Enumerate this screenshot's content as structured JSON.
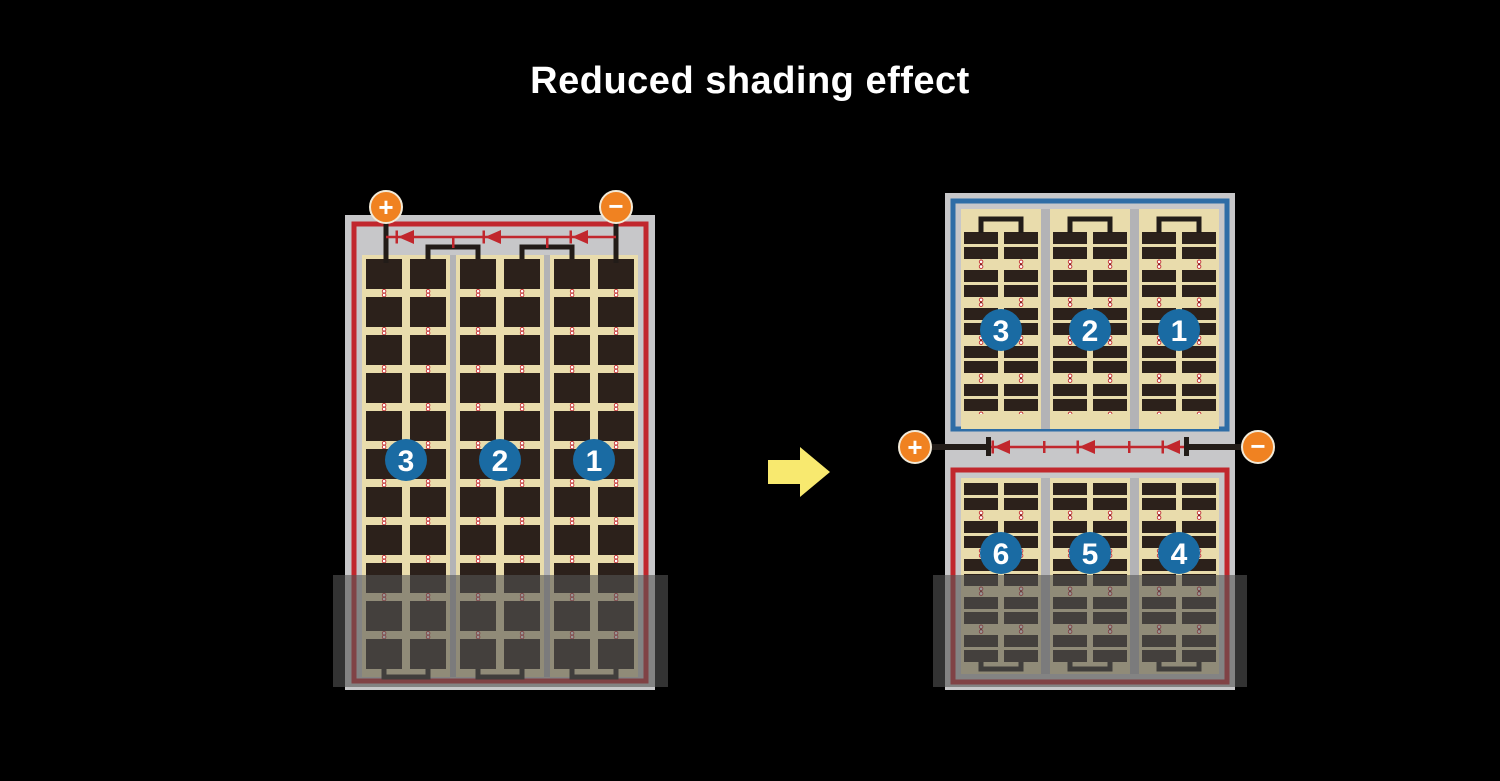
{
  "title": "Reduced shading effect",
  "colors": {
    "background": "#000000",
    "title_text": "#ffffff",
    "panel_frame": "#c7c7c9",
    "cell_field": "#e9dcac",
    "cell": "#2c211b",
    "wire_black": "#221c18",
    "circuit_red": "#c1272d",
    "half_border_blue": "#2e6da6",
    "badge_blue": "#1a6ba3",
    "terminal_orange": "#f08221",
    "arrow_yellow": "#f8e96f",
    "shade_overlay": "rgba(85,85,85,0.6)"
  },
  "left_panel": {
    "positive_terminal": "+",
    "negative_terminal": "−",
    "string_badges": [
      "3",
      "2",
      "1"
    ]
  },
  "right_panel": {
    "positive_terminal": "+",
    "negative_terminal": "−",
    "top_half_badges": [
      "3",
      "2",
      "1"
    ],
    "bottom_half_badges": [
      "6",
      "5",
      "4"
    ]
  }
}
